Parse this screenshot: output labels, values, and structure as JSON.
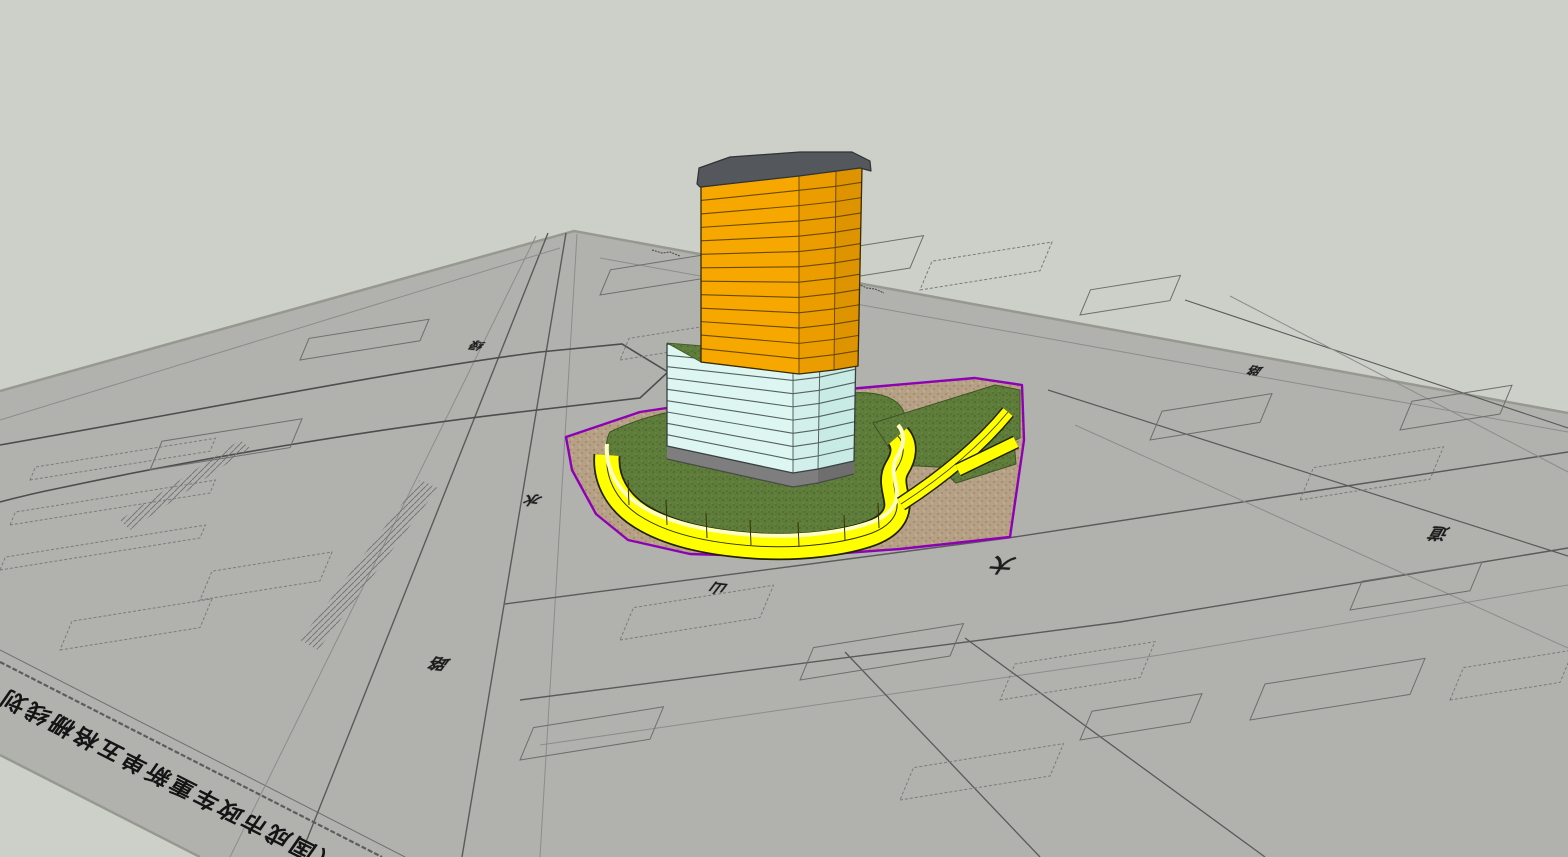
{
  "viewport": {
    "app_context": "3D model view of tower on site plan"
  },
  "colors": {
    "bg": "#cdcfc9",
    "sheet": "#b1b2ae",
    "sheetEdge": "#97988f",
    "line": "#5a5a5a",
    "lineLight": "#8c8c8c",
    "purple": "#8e00b5",
    "tan": "#b6a186",
    "tanDot": "#94805e",
    "grass": "#5f7d3a",
    "grassDark": "#46612b",
    "wallYellow": "#ffff00",
    "wallLip": "#ffffc0",
    "orangeFront": "#f6a800",
    "orangeCorner": "#eb9d00",
    "orangeRight": "#de9400",
    "orangeLine": "#6b4a00",
    "cyanFront": "#def6f2",
    "cyanCorner": "#d2efeb",
    "cyanRight": "#c9ebe6",
    "cyanLine": "#53625f",
    "plinth": "#7e7e7e",
    "plinthRight": "#6e6e6e",
    "roof": "#54585c"
  },
  "building": {
    "upper_floor_count": 13,
    "lower_floor_count": 9
  },
  "site_plan": {
    "road_labels": [
      {
        "text": "绿"
      },
      {
        "text": "水"
      },
      {
        "text": "路"
      },
      {
        "text": "山"
      },
      {
        "text": "大"
      },
      {
        "text": "道"
      },
      {
        "text": "路"
      }
    ],
    "title_strip_text": "（国成市政车重新单五格栅线划"
  }
}
